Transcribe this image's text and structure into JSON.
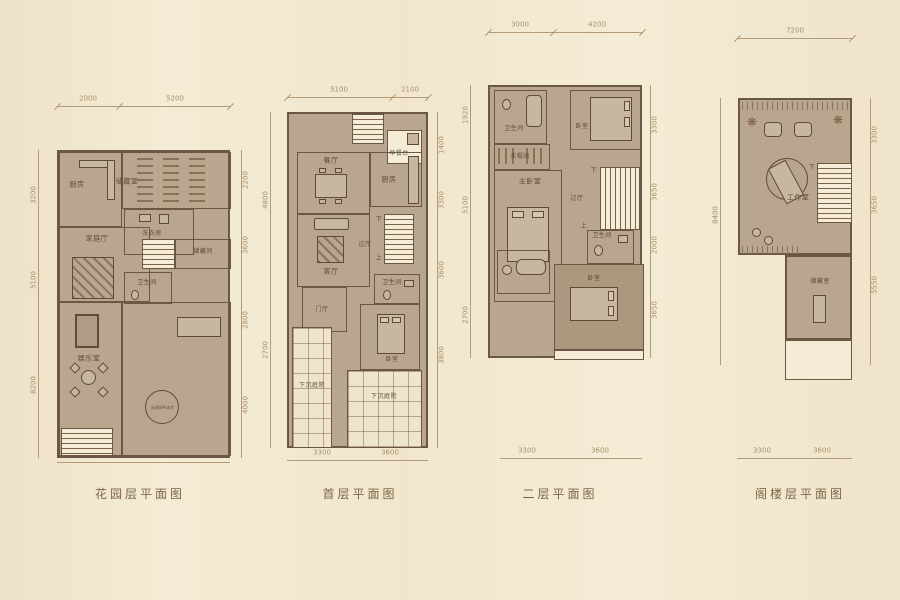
{
  "colors": {
    "background": "#f3ead2",
    "plan_fill": "#b8a68f",
    "wall": "#6b5743",
    "dimension": "#a7906c",
    "caption": "#7c6547"
  },
  "stairs": {
    "up": "上",
    "down": "下"
  },
  "plans": [
    {
      "caption": "花园层平面图",
      "dims": {
        "top": [
          "2000",
          "5200"
        ],
        "bottom": [
          "2000",
          "5200"
        ],
        "left": [
          "3200",
          "5100",
          "8200"
        ],
        "right": [
          "2200",
          "3600",
          "2800",
          "4000"
        ]
      },
      "rooms": {
        "kitchen": "厨房",
        "storage": "储藏室",
        "laundry": "洗衣房",
        "family": "家庭厅",
        "stair_storage": "储藏间",
        "bath": "卫生间",
        "rec": "娱乐室",
        "spa": "泳池SPA水疗"
      }
    },
    {
      "caption": "首层平面图",
      "dims": {
        "top": [
          "5100",
          "2100"
        ],
        "bottom": [
          "3300",
          "3600"
        ],
        "left": [
          "4800",
          "2700"
        ],
        "right": [
          "1400",
          "3300",
          "3600",
          "3800"
        ]
      },
      "rooms": {
        "breakfast": "早餐台",
        "dining": "餐厅",
        "kitchen": "厨房",
        "living": "客厅",
        "hall": "过厅",
        "foyer": "门厅",
        "bath": "卫生间",
        "bedroom": "卧室",
        "courtyard": "下沉庭院"
      }
    },
    {
      "caption": "二层平面图",
      "dims": {
        "top": [
          "3000",
          "4200"
        ],
        "bottom": [
          "3300",
          "3600"
        ],
        "left": [
          "1920",
          "5100",
          "2700"
        ],
        "right": [
          "3300",
          "3650",
          "2000",
          "3650"
        ]
      },
      "rooms": {
        "bath_top": "卫生间",
        "closet": "衣帽间",
        "bedroom_top": "卧室",
        "master": "主卧室",
        "hall": "过厅",
        "bath_bottom": "卫生间",
        "bedroom_bottom": "卧室"
      }
    },
    {
      "caption": "阁楼层平面图",
      "dims": {
        "top": [
          "7200"
        ],
        "bottom": [
          "3300",
          "3600"
        ],
        "left": [
          "8400"
        ],
        "right": [
          "3300",
          "3650",
          "5550"
        ]
      },
      "rooms": {
        "studio": "工作室",
        "storage": "储藏室"
      }
    }
  ]
}
